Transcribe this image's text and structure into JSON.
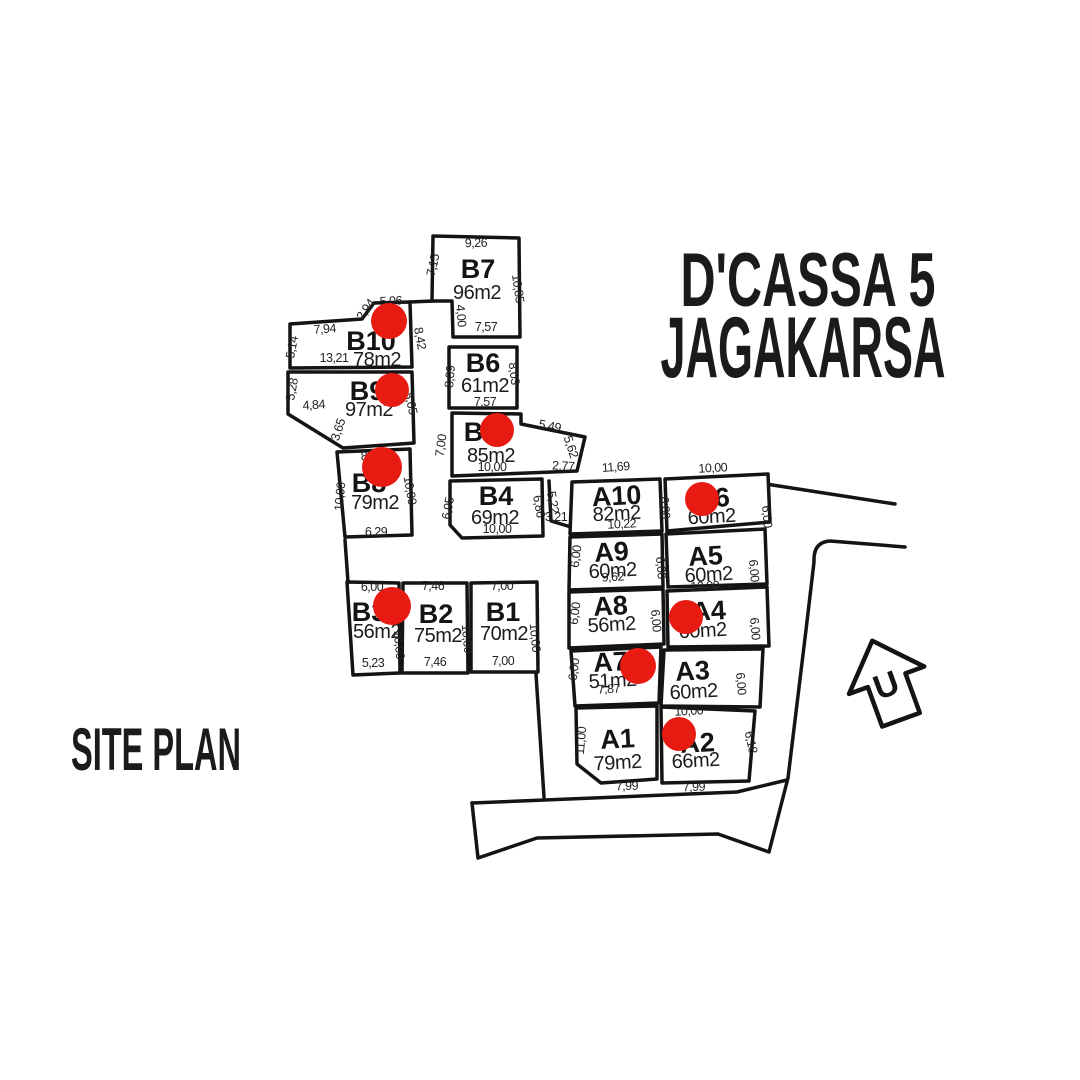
{
  "title": {
    "line1": "D'CASSA 5",
    "line2": "JAGAKARSA"
  },
  "site_plan_label": "SITE PLAN",
  "north_label": "U",
  "colors": {
    "ink": "#141414",
    "sold_dot": "#e81b13",
    "background": "#ffffff"
  },
  "lots": [
    {
      "id": "B7",
      "name": "B7",
      "area": "96m2",
      "points": "433,236 519,238 520,337 453,337 452,301 432,301",
      "nx": 478,
      "ny": 278,
      "ax": 477,
      "ay": 299,
      "rot": 0,
      "dot": null,
      "dims": [
        {
          "t": "9,26",
          "x": 476,
          "y": 247,
          "r": -1
        },
        {
          "t": "7,15",
          "x": 437,
          "y": 266,
          "r": -77
        },
        {
          "t": "10,85",
          "x": 514,
          "y": 289,
          "r": 82
        },
        {
          "t": "4,00",
          "x": 457,
          "y": 316,
          "r": 85
        },
        {
          "t": "7,57",
          "x": 486,
          "y": 331,
          "r": 0
        }
      ]
    },
    {
      "id": "B6",
      "name": "B6",
      "area": "61m2",
      "points": "449,347 517,347 517,408 449,408",
      "nx": 483,
      "ny": 372,
      "ax": 485,
      "ay": 392,
      "rot": 0,
      "dot": null,
      "dims": [
        {
          "t": "8,09",
          "x": 454,
          "y": 377,
          "r": -85
        },
        {
          "t": "8,03",
          "x": 510,
          "y": 374,
          "r": 83
        },
        {
          "t": "7,57",
          "x": 485,
          "y": 406,
          "r": 0
        }
      ]
    },
    {
      "id": "B5",
      "name": "B5",
      "area": "85m2",
      "points": "452,413 521,414 521,424 585,437 577,471 452,476",
      "nx": 481,
      "ny": 441,
      "ax": 491,
      "ay": 462,
      "rot": 0,
      "dot": [
        497,
        430,
        17
      ],
      "dims": [
        {
          "t": "7,00",
          "x": 445,
          "y": 446,
          "r": -82
        },
        {
          "t": "5,49",
          "x": 549,
          "y": 430,
          "r": 11
        },
        {
          "t": "5,62",
          "x": 567,
          "y": 448,
          "r": 72
        },
        {
          "t": "10,00",
          "x": 492,
          "y": 471,
          "r": 0
        },
        {
          "t": "2,77",
          "x": 563,
          "y": 470,
          "r": 3
        }
      ]
    },
    {
      "id": "B4",
      "name": "B4",
      "area": "69m2",
      "points": "450,481 542,479 543,536 462,538 450,525",
      "nx": 496,
      "ny": 505,
      "ax": 495,
      "ay": 524,
      "rot": 0,
      "dot": null,
      "dims": [
        {
          "t": "6,95",
          "x": 452,
          "y": 509,
          "r": -80
        },
        {
          "t": "6,86",
          "x": 535,
          "y": 507,
          "r": 80
        },
        {
          "t": "10,00",
          "x": 497,
          "y": 533,
          "r": 0
        }
      ]
    },
    {
      "id": "B10",
      "name": "B10",
      "area": "78m2",
      "points": "290,324 362,319 374,303 410,302 412,367 290,368",
      "nx": 371,
      "ny": 350,
      "ax": 377,
      "ay": 366,
      "rot": 0,
      "dot": [
        389,
        321,
        18
      ],
      "dims": [
        {
          "t": "5,06",
          "x": 391,
          "y": 305,
          "r": -3
        },
        {
          "t": "2,94",
          "x": 369,
          "y": 312,
          "r": -55
        },
        {
          "t": "7,94",
          "x": 325,
          "y": 333,
          "r": -4
        },
        {
          "t": "5,14",
          "x": 296,
          "y": 348,
          "r": -80
        },
        {
          "t": "13,21",
          "x": 334,
          "y": 362,
          "r": 0
        },
        {
          "t": "8,42",
          "x": 416,
          "y": 339,
          "r": 80
        }
      ]
    },
    {
      "id": "B9",
      "name": "B9",
      "area": "97m2",
      "points": "288,372 412,372 414,443 343,448 288,414",
      "nx": 367,
      "ny": 400,
      "ax": 369,
      "ay": 416,
      "rot": 0,
      "dot": [
        392,
        390,
        17
      ],
      "dims": [
        {
          "t": "5,28",
          "x": 296,
          "y": 390,
          "r": -80
        },
        {
          "t": "4,84",
          "x": 314,
          "y": 409,
          "r": -4
        },
        {
          "t": "8,65",
          "x": 407,
          "y": 404,
          "r": 78
        }
      ]
    },
    {
      "id": "B8",
      "name": "B8",
      "area": "79m2",
      "points": "337,452 410,449 412,535 345,537",
      "nx": 369,
      "ny": 492,
      "ax": 375,
      "ay": 509,
      "rot": 0,
      "dot": [
        382,
        467,
        20
      ],
      "dims": [
        {
          "t": "3,65",
          "x": 342,
          "y": 431,
          "r": -72
        },
        {
          "t": "8,25",
          "x": 372,
          "y": 460,
          "r": -2
        },
        {
          "t": "10,00",
          "x": 344,
          "y": 497,
          "r": -85
        },
        {
          "t": "10,00",
          "x": 406,
          "y": 491,
          "r": 80
        },
        {
          "t": "6,29",
          "x": 376,
          "y": 536,
          "r": 0
        }
      ]
    },
    {
      "id": "B3",
      "name": "B3",
      "area": "56m2",
      "points": "347,582 399,583 400,673 353,675",
      "nx": 369,
      "ny": 621,
      "ax": 377,
      "ay": 638,
      "rot": 0,
      "dot": [
        392,
        606,
        19
      ],
      "dims": [
        {
          "t": "6,00",
          "x": 372,
          "y": 591,
          "r": 0
        },
        {
          "t": "10,00",
          "x": 395,
          "y": 645,
          "r": 85
        },
        {
          "t": "5,23",
          "x": 373,
          "y": 667,
          "r": 0
        }
      ]
    },
    {
      "id": "B2",
      "name": "B2",
      "area": "75m2",
      "points": "403,583 467,583 468,673 402,673",
      "nx": 436,
      "ny": 623,
      "ax": 438,
      "ay": 642,
      "rot": 0,
      "dot": null,
      "dims": [
        {
          "t": "7,46",
          "x": 433,
          "y": 590,
          "r": 0
        },
        {
          "t": "10,00",
          "x": 463,
          "y": 639,
          "r": 85
        },
        {
          "t": "7,46",
          "x": 435,
          "y": 666,
          "r": 0
        }
      ]
    },
    {
      "id": "B1",
      "name": "B1",
      "area": "70m2",
      "points": "471,583 537,582 538,672 471,672",
      "nx": 503,
      "ny": 621,
      "ax": 504,
      "ay": 640,
      "rot": 0,
      "dot": null,
      "dims": [
        {
          "t": "7,00",
          "x": 502,
          "y": 590,
          "r": 0
        },
        {
          "t": "10,00",
          "x": 531,
          "y": 638,
          "r": 85
        },
        {
          "t": "7,00",
          "x": 503,
          "y": 665,
          "r": 0
        }
      ]
    },
    {
      "id": "A10",
      "name": "A10",
      "area": "82m2",
      "points": "572,482 660,479 662,531 570,534",
      "nx": 617,
      "ny": 505,
      "ax": 617,
      "ay": 520,
      "rot": -3,
      "dot": null,
      "dims": [
        {
          "t": "11,69",
          "x": 616,
          "y": 471,
          "r": -4
        },
        {
          "t": "10,22",
          "x": 622,
          "y": 528,
          "r": -3
        },
        {
          "t": "6,00",
          "x": 661,
          "y": 508,
          "r": 85
        }
      ]
    },
    {
      "id": "A6",
      "name": "A6",
      "area": "60m2",
      "points": "665,479 768,474 770,522 667,531",
      "nx": 713,
      "ny": 507,
      "ax": 712,
      "ay": 523,
      "rot": -3,
      "dot": [
        702,
        499,
        17
      ],
      "dims": [
        {
          "t": "10,00",
          "x": 713,
          "y": 472,
          "r": -3
        },
        {
          "t": "6,00",
          "x": 763,
          "y": 517,
          "r": 85
        }
      ]
    },
    {
      "id": "A9",
      "name": "A9",
      "area": "60m2",
      "points": "570,537 662,534 663,587 569,590",
      "nx": 612,
      "ny": 561,
      "ax": 613,
      "ay": 577,
      "rot": -3,
      "dot": null,
      "dims": [
        {
          "t": "6,00",
          "x": 580,
          "y": 557,
          "r": -83
        },
        {
          "t": "9,62",
          "x": 613,
          "y": 581,
          "r": -3
        },
        {
          "t": "6,00",
          "x": 657,
          "y": 568,
          "r": 85
        }
      ]
    },
    {
      "id": "A5",
      "name": "A5",
      "area": "60m2",
      "points": "666,534 765,529 767,584 668,587",
      "nx": 706,
      "ny": 565,
      "ax": 709,
      "ay": 581,
      "rot": -3,
      "dot": null,
      "dims": [
        {
          "t": "6,00",
          "x": 750,
          "y": 571,
          "r": 85
        },
        {
          "t": "10,00",
          "x": 705,
          "y": 590,
          "r": -3
        }
      ]
    },
    {
      "id": "A8",
      "name": "A8",
      "area": "56m2",
      "points": "569,592 663,589 664,644 569,648",
      "nx": 611,
      "ny": 615,
      "ax": 612,
      "ay": 631,
      "rot": -3,
      "dot": null,
      "dims": [
        {
          "t": "6,00",
          "x": 579,
          "y": 614,
          "r": -83
        },
        {
          "t": "6,00",
          "x": 652,
          "y": 621,
          "r": 85
        }
      ]
    },
    {
      "id": "A4",
      "name": "A4",
      "area": "60m2",
      "points": "667,591 767,587 769,646 668,647",
      "nx": 709,
      "ny": 620,
      "ax": 703,
      "ay": 637,
      "rot": -3,
      "dot": [
        686,
        617,
        17
      ],
      "dims": [
        {
          "t": "6,00",
          "x": 751,
          "y": 629,
          "r": 85
        }
      ]
    },
    {
      "id": "A7",
      "name": "A7",
      "area": "51m2",
      "points": "571,651 661,647 659,703 575,706",
      "nx": 611,
      "ny": 671,
      "ax": 613,
      "ay": 687,
      "rot": -3,
      "dot": [
        638,
        666,
        18
      ],
      "dims": [
        {
          "t": "6,00",
          "x": 578,
          "y": 670,
          "r": -83
        },
        {
          "t": "7,87",
          "x": 609,
          "y": 693,
          "r": -3
        }
      ]
    },
    {
      "id": "A3",
      "name": "A3",
      "area": "60m2",
      "points": "664,650 763,649 760,707 661,706",
      "nx": 693,
      "ny": 680,
      "ax": 694,
      "ay": 698,
      "rot": -3,
      "dot": null,
      "dims": [
        {
          "t": "6,00",
          "x": 737,
          "y": 684,
          "r": 85
        },
        {
          "t": "10,00",
          "x": 689,
          "y": 715,
          "r": -3
        }
      ]
    },
    {
      "id": "A1",
      "name": "A1",
      "area": "79m2",
      "points": "576,708 657,706 657,779 601,783 577,764",
      "nx": 618,
      "ny": 748,
      "ax": 618,
      "ay": 769,
      "rot": -3,
      "dot": null,
      "dims": [
        {
          "t": "11,00",
          "x": 585,
          "y": 741,
          "r": -85
        },
        {
          "t": "7,99",
          "x": 627,
          "y": 790,
          "r": -2
        }
      ]
    },
    {
      "id": "A2",
      "name": "A2",
      "area": "66m2",
      "points": "661,707 755,711 749,781 662,783",
      "nx": 698,
      "ny": 752,
      "ax": 696,
      "ay": 767,
      "rot": -3,
      "dot": [
        679,
        734,
        17
      ],
      "dims": [
        {
          "t": "6,18",
          "x": 747,
          "y": 743,
          "r": 78
        },
        {
          "t": "7,99",
          "x": 694,
          "y": 791,
          "r": -2
        }
      ]
    }
  ],
  "extra_dims": [
    {
      "t": "5,22",
      "x": 549,
      "y": 503,
      "r": 80
    },
    {
      "t": "3,21",
      "x": 556,
      "y": 521,
      "r": 0
    }
  ],
  "roads": [
    "M345,540 L348,582",
    "M536,674 L544,797",
    "M472,803 L478,858 L537,838 L718,834 L769,852 L788,778 L806,630 L814,562 Q813,542 830,541 L905,547",
    "M472,803 L737,792 L787,780",
    "M766,484 L895,504",
    "M410,302 L433,301",
    "M549,481 L551,521 L571,527"
  ]
}
